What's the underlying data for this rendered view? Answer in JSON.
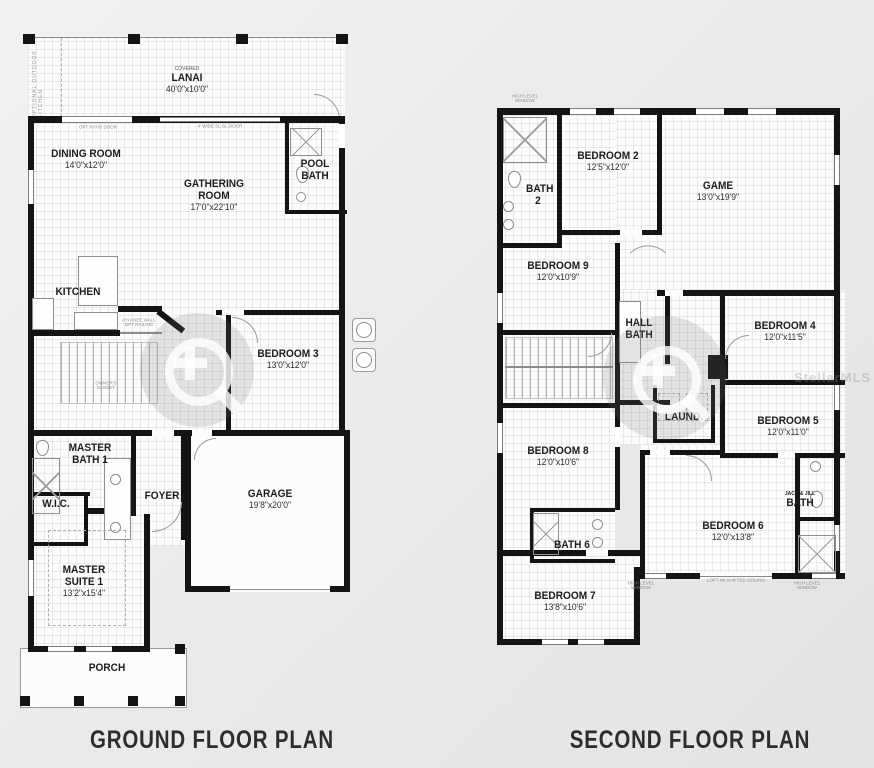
{
  "titles": {
    "ground": "GROUND FLOOR PLAN",
    "second": "SECOND FLOOR PLAN"
  },
  "watermark": {
    "mls": "StellarMLS"
  },
  "ground": {
    "rooms": {
      "lanai": {
        "pre": "COVERED",
        "name": "LANAI",
        "dims": "40'0\"x10'0\""
      },
      "dining": {
        "name": "DINING ROOM",
        "dims": "14'0\"x12'0\""
      },
      "gathering": {
        "name": "GATHERING ROOM",
        "dims": "17'0\"x22'10\""
      },
      "pool_bath": {
        "name": "POOL BATH"
      },
      "kitchen": {
        "name": "KITCHEN"
      },
      "bedroom3": {
        "name": "BEDROOM 3",
        "dims": "13'0\"x12'0\""
      },
      "master_bath": {
        "name": "MASTER BATH 1"
      },
      "wic": {
        "name": "W.I.C."
      },
      "foyer": {
        "name": "FOYER"
      },
      "garage": {
        "name": "GARAGE",
        "dims": "19'8\"x20'0\""
      },
      "master_suite": {
        "name": "MASTER SUITE 1",
        "dims": "13'2\"x15'4\""
      },
      "porch": {
        "name": "PORCH"
      }
    },
    "annotations": {
      "patio_door": "OPT PATIO DOOR",
      "slider": "4' WIDE SL GL DOOR",
      "outdoor_kitchen": "OPTIONAL OUTDOOR KITCHEN",
      "knee_wall": "4'H KNEE WALL OPT RAILING",
      "owners_closet": "OWNER'S CLOSET"
    }
  },
  "second": {
    "rooms": {
      "bath2": {
        "name": "BATH 2"
      },
      "bedroom2": {
        "name": "BEDROOM 2",
        "dims": "12'5\"x12'0\""
      },
      "game": {
        "name": "GAME",
        "dims": "13'0\"x19'9\""
      },
      "bedroom9": {
        "name": "BEDROOM 9",
        "dims": "12'0\"x10'9\""
      },
      "hall_bath": {
        "name": "HALL BATH"
      },
      "bedroom4": {
        "name": "BEDROOM 4",
        "dims": "12'0\"x11'5\""
      },
      "laundry": {
        "name": "LAUND."
      },
      "bedroom5": {
        "name": "BEDROOM 5",
        "dims": "12'0\"x11'0\""
      },
      "bedroom8": {
        "name": "BEDROOM 8",
        "dims": "12'0\"x10'6\""
      },
      "bath6": {
        "name": "BATH 6"
      },
      "bedroom6": {
        "name": "BEDROOM 6",
        "dims": "12'0\"x13'8\""
      },
      "jack_jill": {
        "small": "JACK & JILL",
        "name": "BATH"
      },
      "bedroom7": {
        "name": "BEDROOM 7",
        "dims": "13'8\"x10'6\""
      }
    },
    "annotations": {
      "high_window_1": "HIGH LEVEL WINDOW",
      "high_window_2": "HIGH LEVEL WINDOW",
      "high_window_3": "HIGH LEVEL WINDOW",
      "loft": "LOFT W/ SHIFTED CEILING"
    }
  }
}
